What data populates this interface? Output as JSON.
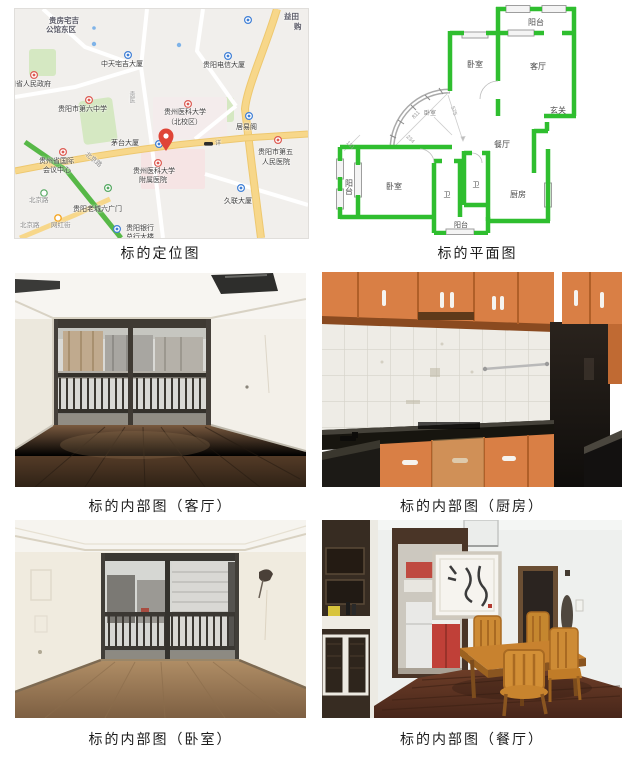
{
  "captions": {
    "map": "标的定位图",
    "floorplan": "标的平面图",
    "living": "标的内部图（客厅）",
    "kitchen": "标的内部图（厨房）",
    "bedroom": "标的内部图（卧室）",
    "dining": "标的内部图（餐厅）"
  },
  "map": {
    "labels": [
      "贵房宅吉",
      "公馆东区",
      "益田",
      "购",
      "中天宅吉大厦",
      "贵阳电信大厦",
      "州省人民政府",
      "贵阳市第六中学",
      "贵州医科大学",
      "（北校区）",
      "茅台大厦",
      "详",
      "居易阁",
      "贵阳市第五",
      "人民医院",
      "贵州省国际",
      "会议中心",
      "贵州医科大学",
      "附属医院",
      "北京路",
      "贵阳老城六广门",
      "久联大厦",
      "北京路",
      "网红街",
      "贵阳银行",
      "总行大楼",
      "北京路",
      "贵医"
    ],
    "colors": {
      "road_major": "#f7d78a",
      "road_green": "#57b847",
      "park": "#d5e8c2",
      "pin": "#df4537"
    }
  },
  "floorplan": {
    "rooms": [
      "阳台",
      "卧室",
      "客厅",
      "玄关",
      "餐厅",
      "阳台",
      "卧室",
      "卫",
      "卫",
      "厨房",
      "阳台",
      "卧室"
    ],
    "dims": [
      "811",
      "575",
      "234",
      "131"
    ],
    "wall_color": "#2fbe2f"
  }
}
